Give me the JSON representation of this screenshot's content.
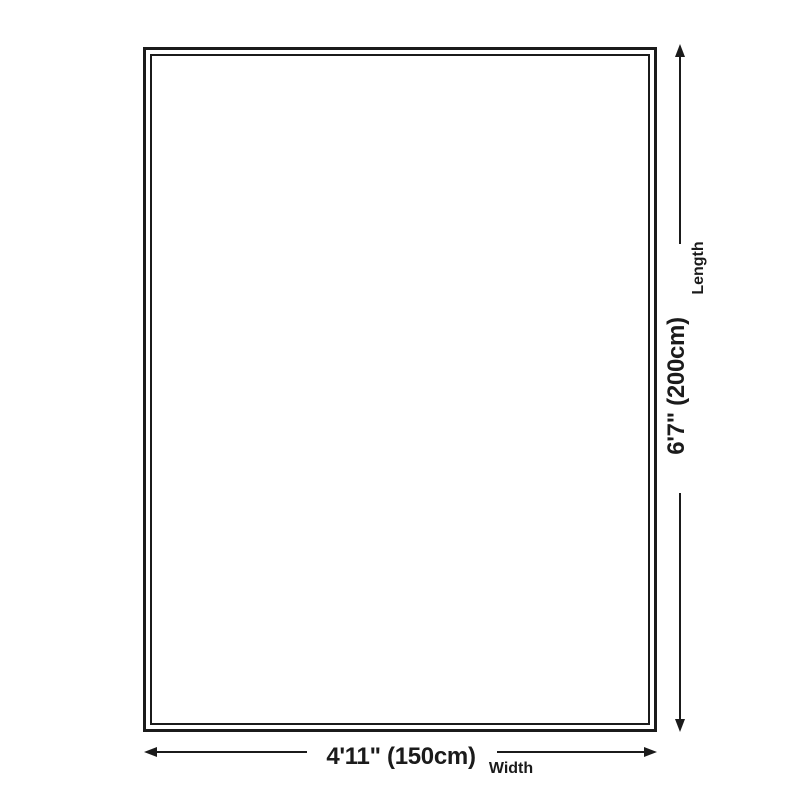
{
  "diagram": {
    "length": {
      "value": "6'7\" (200cm)",
      "label": "Length"
    },
    "width": {
      "value": "4'11\" (150cm)",
      "label": "Width"
    }
  },
  "icons": {
    "arrow_up": "arrow-up-icon",
    "arrow_down": "arrow-down-icon",
    "arrow_left": "arrow-left-icon",
    "arrow_right": "arrow-right-icon"
  },
  "colors": {
    "line": "#1b1b1b",
    "text": "#1b1b1b",
    "background": "#ffffff"
  }
}
